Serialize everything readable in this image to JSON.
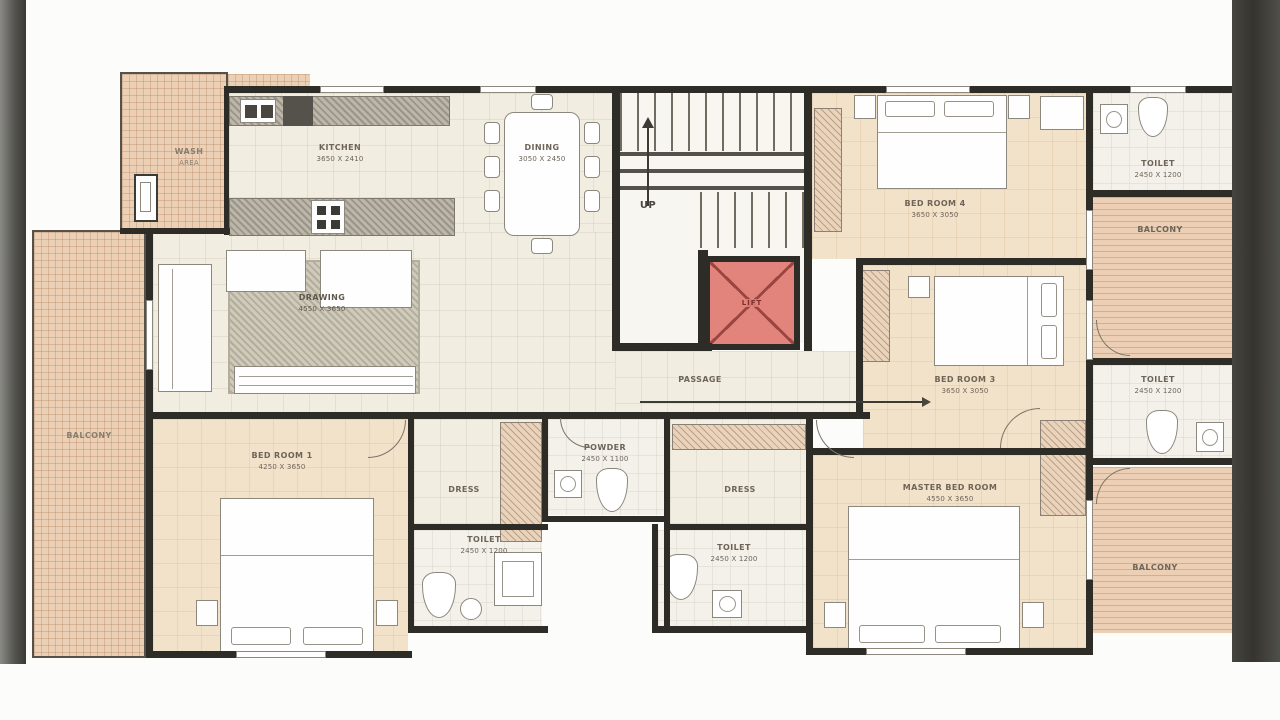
{
  "colors": {
    "wall": "#2e2c27",
    "lift_fill": "#e2837c",
    "lift_cross": "#9a453f",
    "balcony_floor": "#eccfb4",
    "interior_floor": "#f1ede1",
    "bedroom_floor": "#f3e2ca"
  },
  "rooms": {
    "kitchen": {
      "name": "KITCHEN",
      "dim": "3650 X 2410"
    },
    "dining": {
      "name": "DINING",
      "dim": "3050 X 2450"
    },
    "drawing": {
      "name": "DRAWING",
      "dim": "4550 X 3650"
    },
    "passage": {
      "name": "PASSAGE"
    },
    "up": {
      "name": "UP"
    },
    "lift": {
      "name": "LIFT"
    },
    "wash": {
      "name": "WASH",
      "dim": "AREA"
    },
    "bedroom4": {
      "name": "BED ROOM 4",
      "dim": "3650 X 3050"
    },
    "bedroom3": {
      "name": "BED ROOM 3",
      "dim": "3650 X 3050"
    },
    "master": {
      "name": "MASTER BED ROOM",
      "dim": "4550 X 3650"
    },
    "bedroom1": {
      "name": "BED ROOM 1",
      "dim": "4250 X 3650"
    },
    "toilet_tr": {
      "name": "TOILET",
      "dim": "2450 X 1200"
    },
    "toilet_mr": {
      "name": "TOILET",
      "dim": "2450 X 1200"
    },
    "toilet_bl": {
      "name": "TOILET",
      "dim": "2450 X 1200"
    },
    "toilet_bm": {
      "name": "TOILET",
      "dim": "2450 X 1200"
    },
    "powder": {
      "name": "POWDER",
      "dim": "2450 X 1100"
    },
    "dress_l": {
      "name": "DRESS"
    },
    "dress_r": {
      "name": "DRESS"
    },
    "balcony_l": {
      "name": "BALCONY"
    },
    "balcony_tr": {
      "name": "BALCONY"
    },
    "balcony_br": {
      "name": "BALCONY"
    }
  }
}
